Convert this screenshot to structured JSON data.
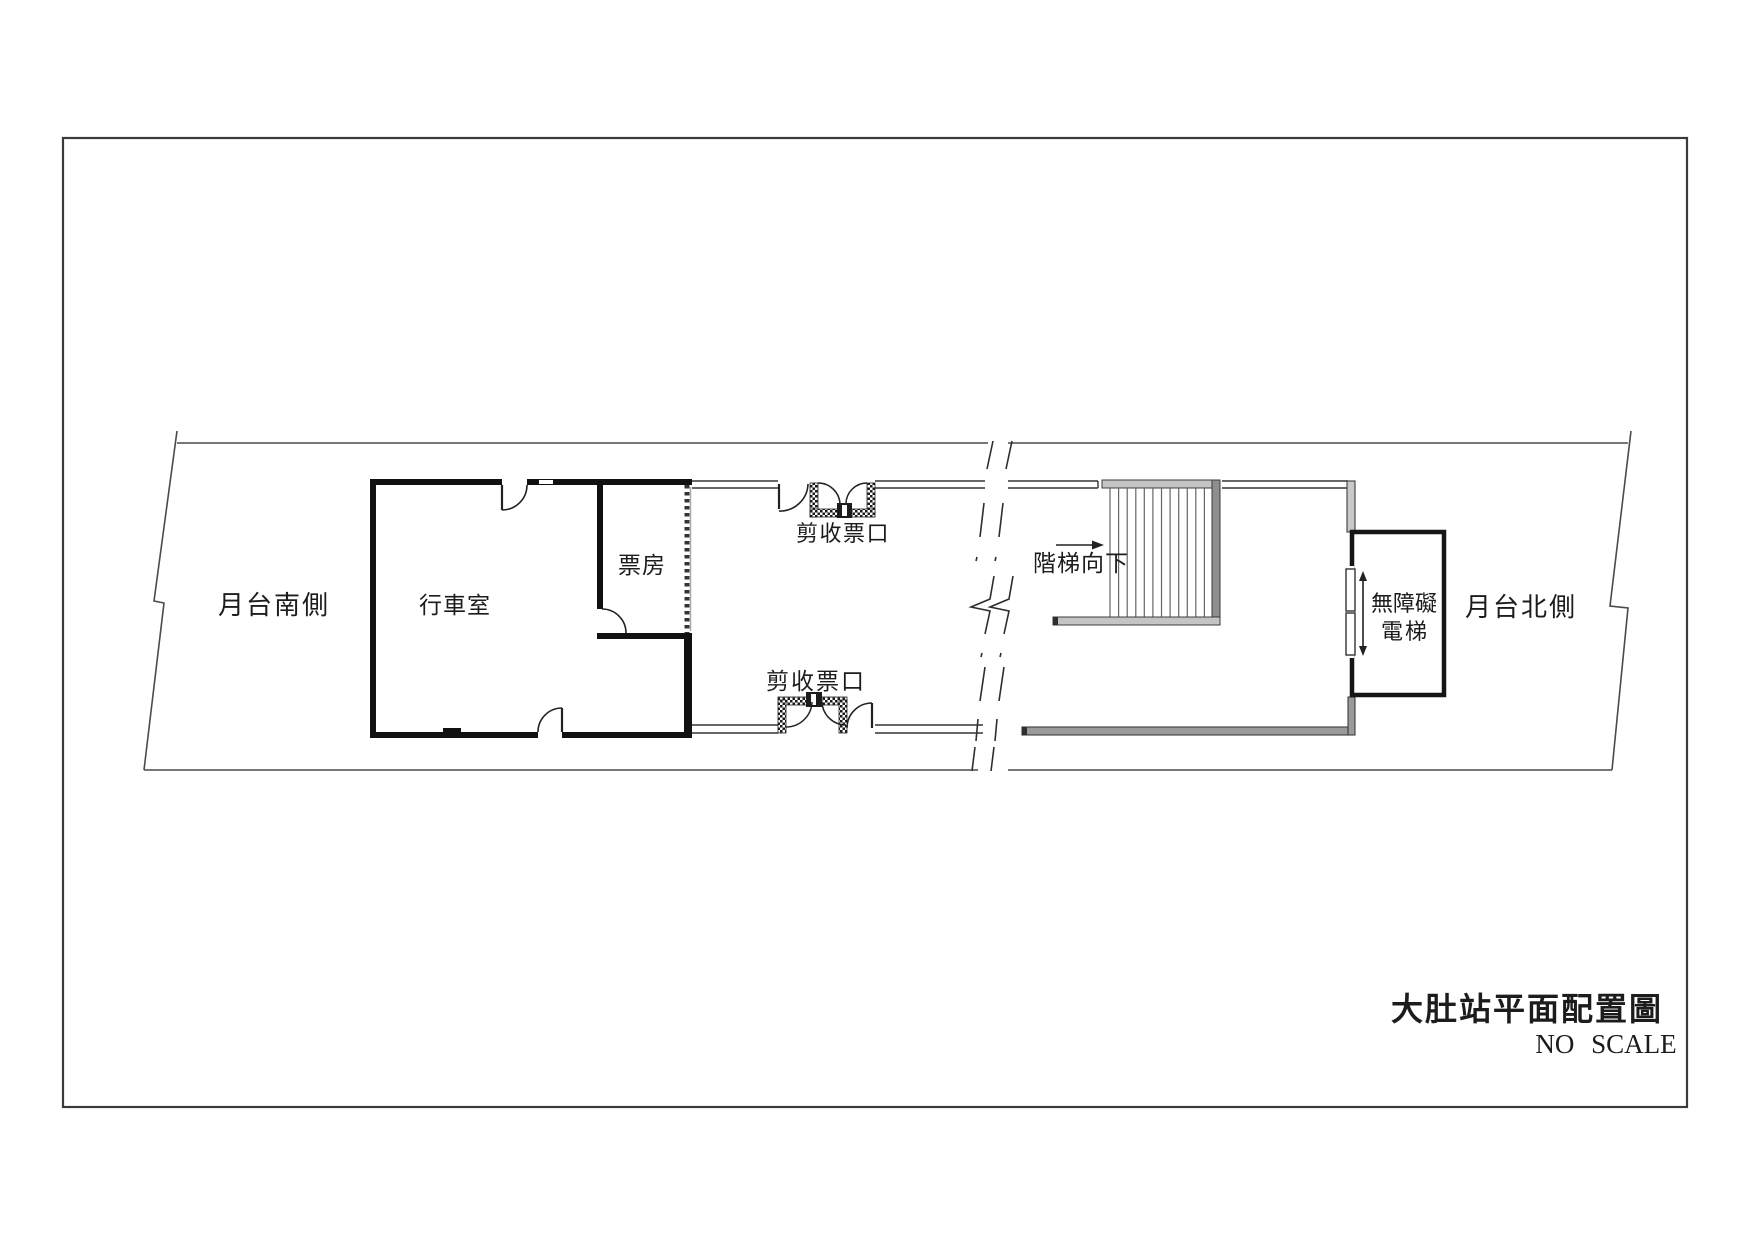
{
  "document": {
    "type": "station floor plan sheet",
    "background_color": "#ffffff",
    "line_color": "#1a1a1a",
    "wall_gray_color": "#9a9a9a"
  },
  "labels": {
    "platform_south": "月台南側",
    "operation_room": "行車室",
    "ticket_office": "票房",
    "ticket_gate_upper": "剪收票口",
    "ticket_gate_lower": "剪收票口",
    "stairs_down": "階梯向下",
    "elevator_line1": "無障礙",
    "elevator_line2": "電梯",
    "platform_north": "月台北側"
  },
  "title_block": {
    "title": "大肚站平面配置圖",
    "scale_note": "NO SCALE"
  }
}
